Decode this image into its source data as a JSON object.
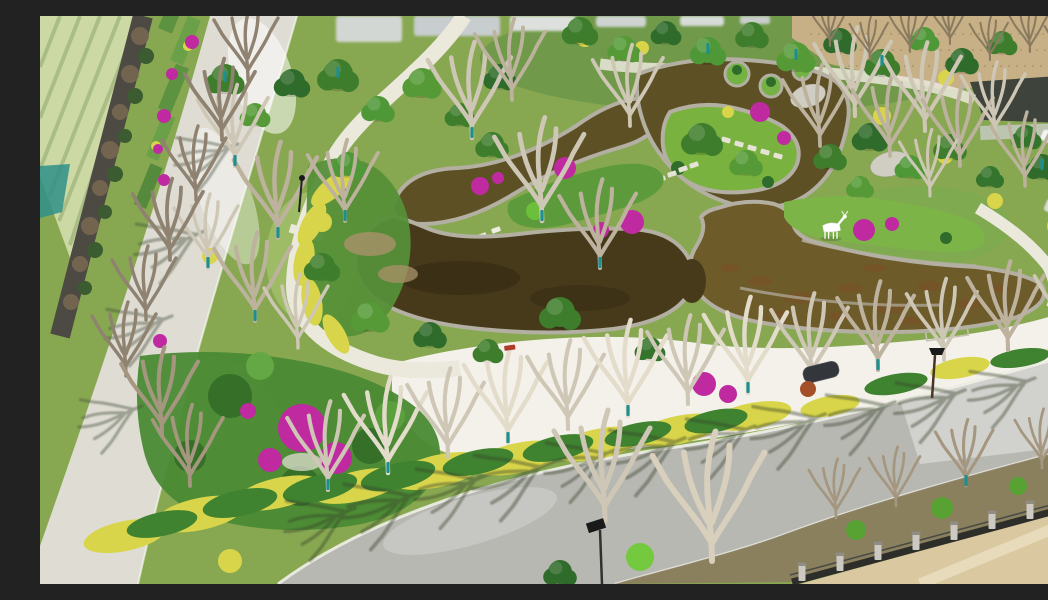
{
  "scene": {
    "description": "Aerial drone photograph of a newly landscaped park in early spring: a terraced amber koi pond with stone edging, winding white garden paths, magenta bougainvillea and golden hedges, young staked trees with teal trunk guards, a white deer sculpture on the pond bank, bordered by a bright concrete perimeter road beside farmland on the left and a gray asphalt road with street trees, an iron fence and a sandy lot at the bottom right, with a bare dirt field, parked cars and greenhouses at the top right",
    "features": {
      "farmland": "crop fields with planting rows",
      "boundary_wall": "dark boundary wall with dry hedge and tree line",
      "perimeter_road": "bright concrete perimeter road",
      "terrace_planters": "stepped roadside planters with bougainvillea",
      "main_road": "asphalt road with street trees casting shadows",
      "plaza": "sunlit white lakeside plaza",
      "garden_paths": "winding white garden paths with stepping pads",
      "pond": "terraced amber pond with stone retaining walls",
      "pond_islands": "planted islands and clipped lawn mounds",
      "stepping_stones": "stone slab crossings over the water",
      "deer_sculpture": "white deer statue on the lawn bank",
      "flower_beds": "magenta bougainvillea flower clusters",
      "hedges": "golden privet hedge bands",
      "green_trees": "evergreen and leafing trees",
      "bare_trees": "leafless deciduous saplings",
      "tree_guards": "teal trunk guards on staked saplings",
      "street_lamps": "solar street lamps",
      "canopy": "dark shade canopy by the plaza",
      "bench": "red garden bench",
      "rocks": "light gray landscape boulders",
      "fence": "iron fence with stone pillars",
      "sand_lot": "sandy construction lot",
      "parking": "parked cars and greenhouse sheds",
      "buildings": "low pale buildings beyond the trees",
      "dirt_field": "bare earth field with twiggy saplings",
      "tarp": "teal tarp at the field edge",
      "shadows": "tree shadows cast across the road"
    }
  },
  "palette": {
    "lawn_green": "#87a851",
    "lawn_bright": "#a2bf6a",
    "field_green": "#ccd9a4",
    "field_stripe": "#a6b982",
    "wall_dark": "#4c4a42",
    "road_light": "#dedcd3",
    "road_asphalt": "#b8b8b3",
    "plaza_white": "#f3f1ea",
    "path_white": "#ebe8dc",
    "pond_amber": "#6d5b2a",
    "pond_amber_dark": "#5d5025",
    "pond_dark": "#463a1a",
    "pond_russet": "#7c5026",
    "stone_edge": "#b3afa2",
    "island_green": "#75b244",
    "hedge_yellow": "#d9d54a",
    "shrub_dark": "#2f6b2b",
    "shrub_mid": "#4f9838",
    "bougainvillea": "#bf2aa0",
    "bare_branch": "#cfc7b6",
    "tree_guard_teal": "#1e8f8f",
    "dirt_tan": "#c7b086",
    "sand": "#d9c8a0",
    "fence_iron": "#2d2d2a",
    "fence_pillar": "#cbc9c1",
    "lamp_black": "#1a1a1a",
    "deer_white": "#ffffff",
    "shadow_green": "#39442c",
    "boulder_gray": "#d0cdc3",
    "tarp_teal": "#2f8f88",
    "greenhouse_gray": "#d7d9d5",
    "car_white": "#f4f4f2"
  }
}
